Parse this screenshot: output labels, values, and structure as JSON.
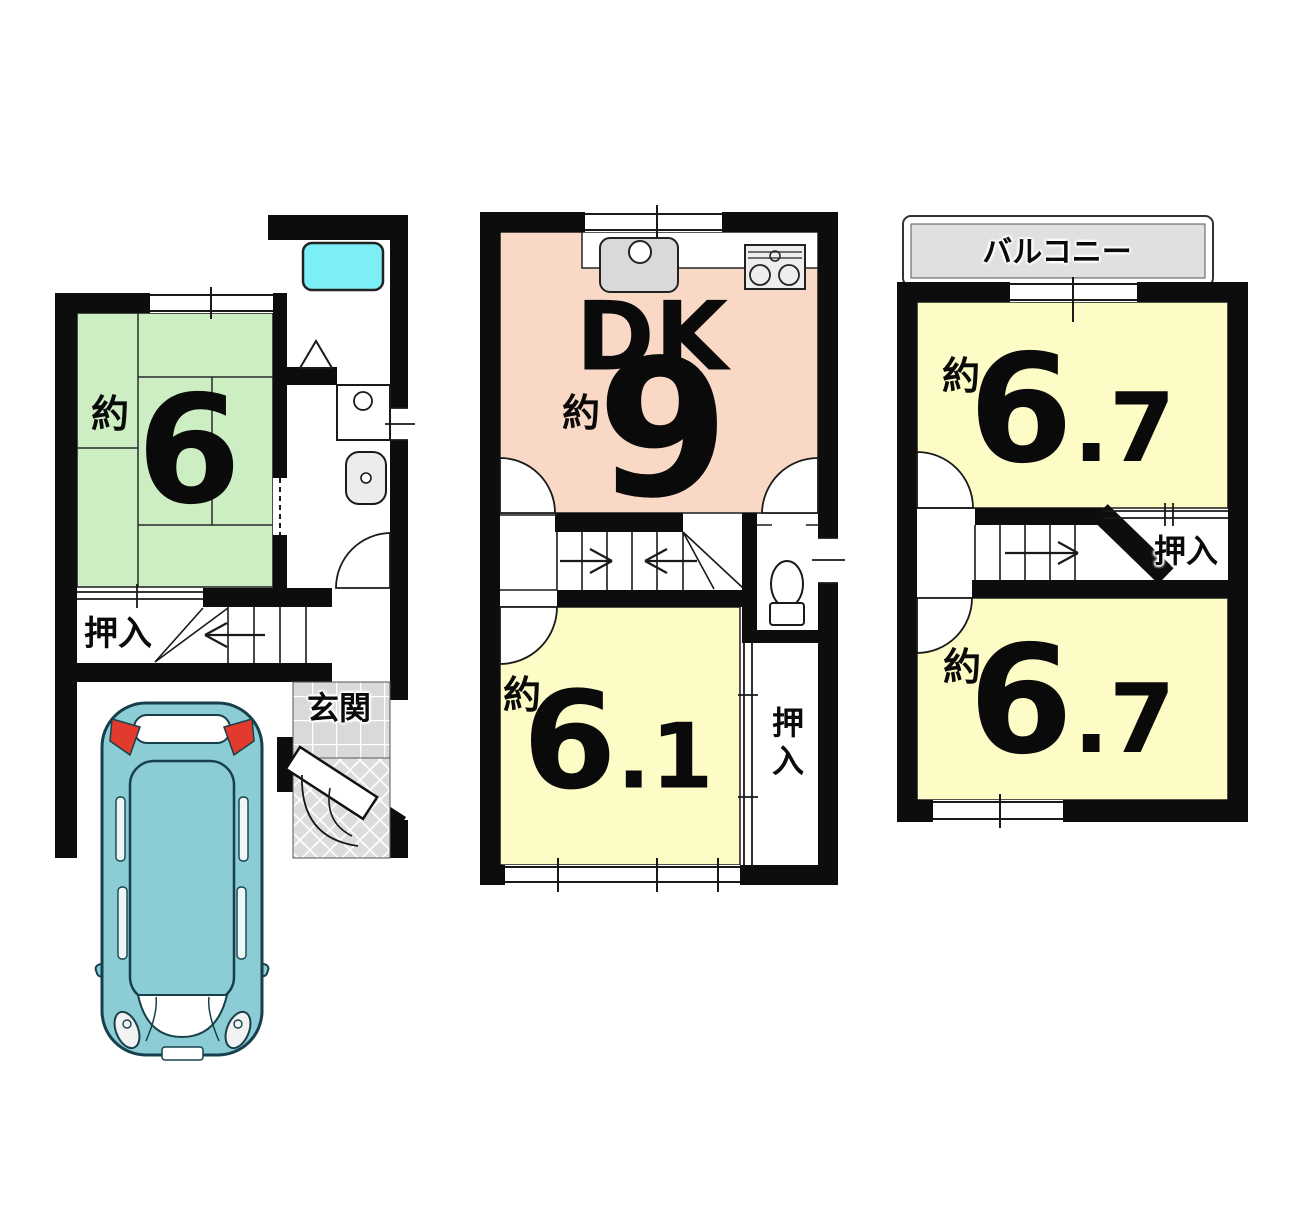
{
  "floors": {
    "first": {
      "tatami_room": {
        "approx": "約",
        "size": "6"
      },
      "closet_label": "押入",
      "entrance_label": "玄関"
    },
    "second": {
      "dk_label": "DK",
      "dk_approx": "約",
      "dk_size": "9",
      "bedroom": {
        "approx": "約",
        "size_int": "6",
        "size_dec": ".1"
      },
      "closet_label": "押入"
    },
    "third": {
      "balcony_label": "バルコニー",
      "room_upper": {
        "approx": "約",
        "size_int": "6",
        "size_dec": ".7"
      },
      "closet_label": "押入",
      "room_lower": {
        "approx": "約",
        "size_int": "6",
        "size_dec": ".7"
      }
    }
  },
  "colors": {
    "wall": "#0d0d0d",
    "tatami_green": "#cdeec3",
    "dk_salmon": "#f9d8c5",
    "room_yellow": "#fdfbc6",
    "bathtub_cyan": "#7ceef5",
    "balcony_gray": "#e0e0e0",
    "tile_gray": "#d9d9d9",
    "car_teal": "#8bccd5",
    "car_red": "#e23b2e"
  },
  "icons": {
    "bathtub-icon": "cyan rounded rectangle",
    "shower-triangle-icon": "triangle glyph",
    "washbasin-icon": "square with faucet circle",
    "vanity-sink-icon": "rounded square basin",
    "kitchen-sink-icon": "rounded rectangle with faucet circle",
    "stove-icon": "rectangle with two burner circles",
    "toilet-icon": "bowl with tank",
    "car-icon": "top view car",
    "stair-arrow-icon": "chevron direction arrow",
    "door-arc-icon": "quarter circle swing"
  }
}
